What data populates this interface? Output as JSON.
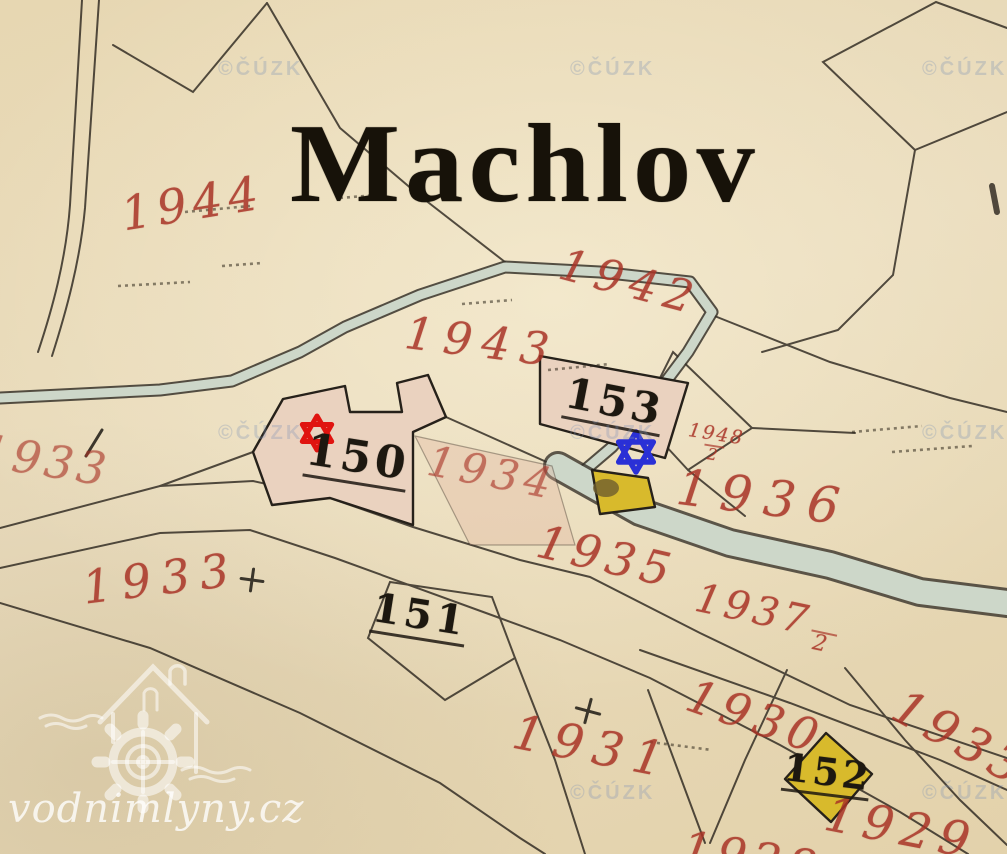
{
  "title": "Machlov",
  "watermark": {
    "site": "vodnimlyny.cz",
    "logo": "watermill-house-gear"
  },
  "copyright": "©ČÚZK",
  "red_labels": [
    {
      "text": "1944"
    },
    {
      "text": "1942"
    },
    {
      "text": "1943"
    },
    {
      "text": "1934"
    },
    {
      "num": "1948",
      "den": "2"
    },
    {
      "text": "1936"
    },
    {
      "text": "1935"
    },
    {
      "text": "1933"
    },
    {
      "text": "1933"
    },
    {
      "num": "1937",
      "den": "2"
    },
    {
      "text": "1931"
    },
    {
      "text": "1930"
    },
    {
      "text": "1929"
    },
    {
      "text": "1933"
    },
    {
      "text": "1928"
    }
  ],
  "black_labels": [
    {
      "text": "150"
    },
    {
      "text": "151"
    },
    {
      "text": "152"
    },
    {
      "text": "153"
    }
  ],
  "markers": [
    {
      "name": "red-star-marker",
      "color": "#e01410"
    },
    {
      "name": "blue-star-marker",
      "color": "#2a30d6"
    }
  ],
  "colors": {
    "paper": "#e7d7b2",
    "ink": "#2e2820",
    "parcel_red": "#a93326",
    "stream": "#cdd7c9",
    "wooden_building_yellow": "#d8ba2c",
    "masonry_building_pink": "#ead2bf"
  }
}
